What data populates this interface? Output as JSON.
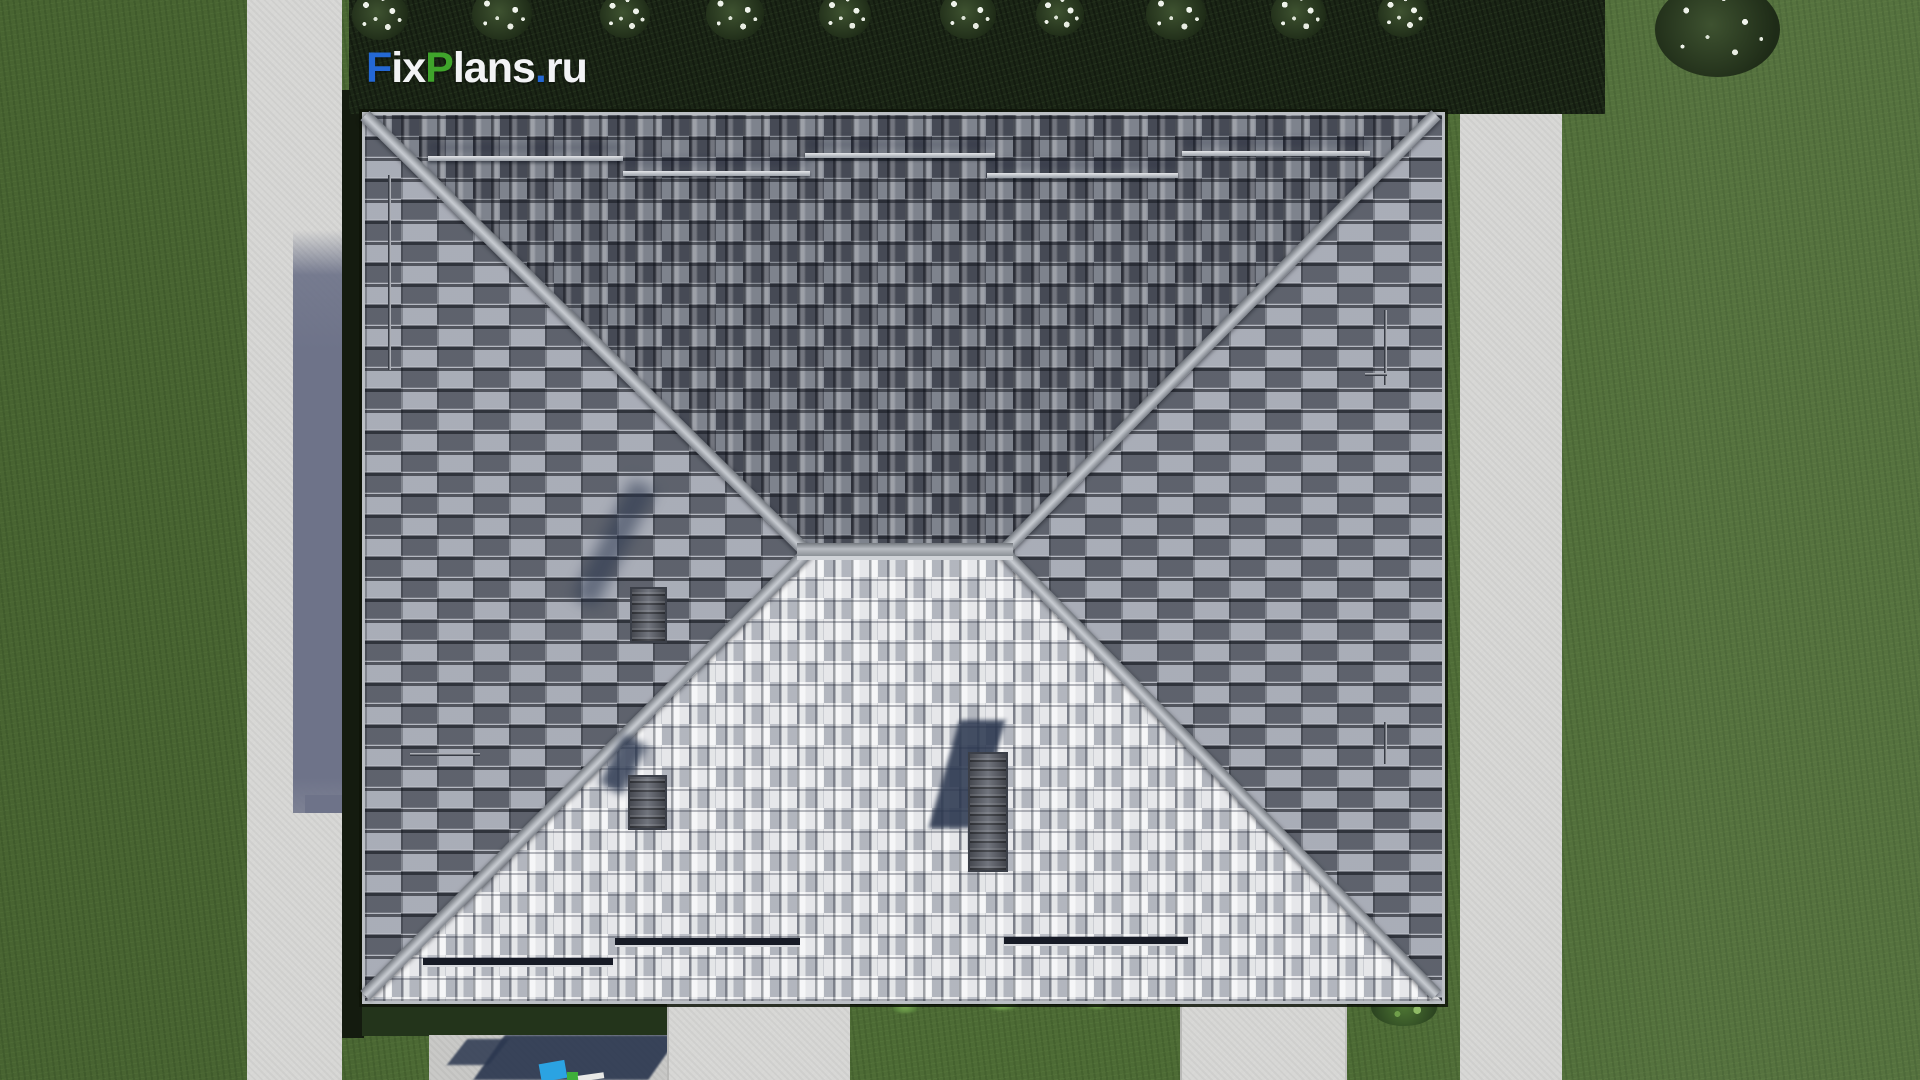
{
  "watermark": {
    "text": "FixPlans.ru",
    "segments": [
      {
        "text": "F",
        "color": "#2468d4"
      },
      {
        "text": "ix",
        "color": "#f2f3f5"
      },
      {
        "text": "P",
        "color": "#3fa42b"
      },
      {
        "text": "lans",
        "color": "#f2f3f5"
      },
      {
        "text": ".",
        "color": "#2468d4"
      },
      {
        "text": "ru",
        "color": "#f2f3f5"
      }
    ]
  },
  "scene": {
    "description": "Aerial top-down 3D render of a hip-roof house",
    "objects": [
      "lawn",
      "hedge-with-flowering-bushes",
      "sidewalk-left",
      "sidewalk-right",
      "hip-roof",
      "ridge",
      "snow-guards",
      "chimneys",
      "walkway-bottom-left",
      "walkway-bottom-right",
      "patio-with-furniture",
      "leaf-bush"
    ]
  },
  "palette": {
    "grass": "#4d6b35",
    "hedge": "#1b2616",
    "path": "#d7d7d5",
    "path_shadow": "#6e7389",
    "roof_face_dark": "#636873",
    "roof_face_light": "#ccced4",
    "roof_face_side": "#8d929c",
    "hip_ridge": "#b8bcc2",
    "chimney": "#5d616b",
    "shadow_navy": "#2c3850",
    "patio_cyan_object": "#2ba3e2",
    "patio_green_object": "#3fae3a",
    "patio_white_object": "#e9e9e7"
  }
}
